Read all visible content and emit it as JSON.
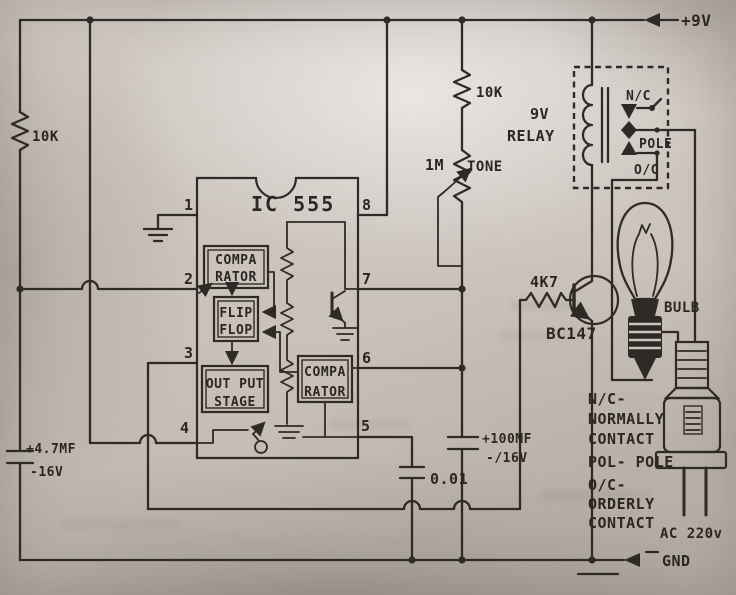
{
  "colors": {
    "paper": "#c9c3bb",
    "ink": "#2e2a26"
  },
  "power": {
    "vcc": "+9V",
    "gnd": "GND"
  },
  "components": {
    "r_left": "10K",
    "r_top": "10K",
    "r_base": "4K7",
    "pot_value": "1M",
    "pot_label": "TONE",
    "transistor": "BC147",
    "c1_value": "+4.7MF",
    "c1_voltage": "-16V",
    "c2_value": "+100MF",
    "c2_voltage": "-/16V",
    "c3_value": "0.01",
    "relay_line1": "9V",
    "relay_line2": "RELAY",
    "bulb": "BULB",
    "ac": "AC 220v"
  },
  "ic": {
    "title": "IC 555",
    "pins": [
      "1",
      "2",
      "3",
      "4",
      "5",
      "6",
      "7",
      "8"
    ],
    "comparator_top": [
      "COMPA",
      "RATOR"
    ],
    "flipflop": [
      "FLIP",
      "FLOP"
    ],
    "output_stage": [
      "OUT PUT",
      "STAGE"
    ],
    "comparator_bottom": [
      "COMPA",
      "RATOR"
    ]
  },
  "relay_contacts": {
    "nc": "N/C",
    "pole": "POLE",
    "oc": "O/C"
  },
  "legend": [
    "N/C-",
    "NORMALLY",
    "CONTACT",
    "POL- POLE",
    "O/C-",
    "ORDERLY",
    "CONTACT"
  ]
}
